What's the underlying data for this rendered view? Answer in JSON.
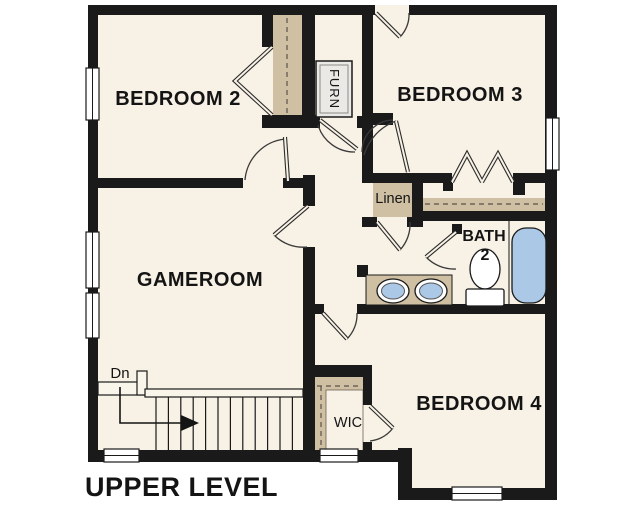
{
  "title": {
    "label": "UPPER LEVEL"
  },
  "rooms": {
    "bedroom2": "BEDROOM 2",
    "bedroom3": "BEDROOM 3",
    "bedroom4": "BEDROOM 4",
    "gameroom": "GAMEROOM",
    "bath2_line1": "BATH",
    "bath2_line2": "2",
    "linen": "Linen",
    "wic": "WIC",
    "furnace": "FURN"
  },
  "stairs": {
    "down_label": "Dn"
  },
  "colors": {
    "background": "#ffffff",
    "wall": "#1a1a1a",
    "floor": "#f8f1e5",
    "shelf": "#cfc0a4",
    "fixture_water": "#abc9e6",
    "furnace_fill": "#eae9e5"
  }
}
